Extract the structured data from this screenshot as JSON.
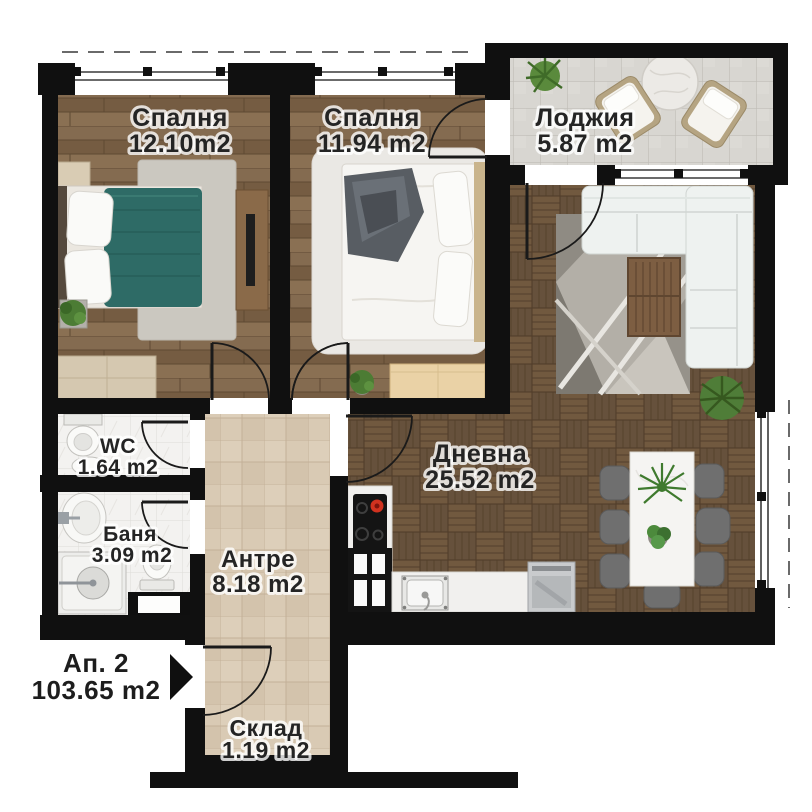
{
  "plan": {
    "apartment": {
      "label": "Ап. 2",
      "area": "103.65 m2"
    },
    "rooms": [
      {
        "id": "bedroom-1",
        "name": "Спалня",
        "area": "12.10m2"
      },
      {
        "id": "bedroom-2",
        "name": "Спалня",
        "area": "11.94 m2"
      },
      {
        "id": "loggia",
        "name": "Лоджия",
        "area": "5.87 m2"
      },
      {
        "id": "living",
        "name": "Дневна",
        "area": "25.52 m2"
      },
      {
        "id": "wc",
        "name": "WC",
        "area": "1.64 m2"
      },
      {
        "id": "bath",
        "name": "Баня",
        "area": "3.09 m2"
      },
      {
        "id": "hall",
        "name": "Антре",
        "area": "8.18 m2"
      },
      {
        "id": "storage",
        "name": "Склад",
        "area": "1.19 m2"
      }
    ],
    "icons": {
      "entrance": "entrance-arrow-icon"
    },
    "colors": {
      "wall": "#101010",
      "bedroom_wood": "#7d644a",
      "living_parquet": "#6d563f",
      "loggia_tile": "#d8d6d1",
      "hall_tile": "#d9cab4",
      "bath_tile": "#f3f2f0",
      "bed_teal": "#2e6b66",
      "sofa_white": "#eef2f0",
      "chair_gray": "#6f6f6f",
      "burner_red": "#d0321f",
      "plant_green": "#4c7c34"
    }
  }
}
